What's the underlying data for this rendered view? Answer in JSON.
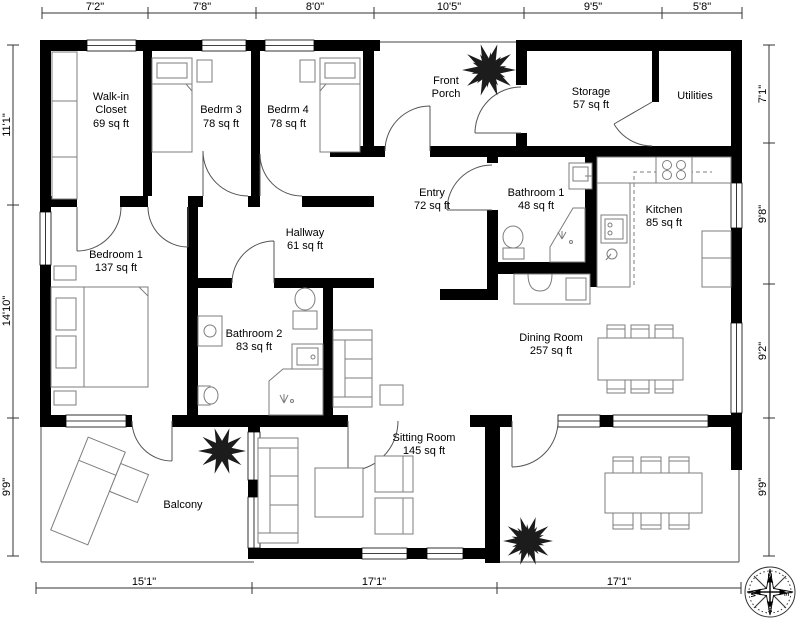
{
  "colors": {
    "wall": "#000000",
    "furniture": "#7d7d7d",
    "door": "#555555",
    "outline": "#6a6a6a",
    "plant": "#1c1c1c"
  },
  "rooms": {
    "walkin": {
      "l1": "Walk-in",
      "l2": "Closet",
      "area": "69 sq ft"
    },
    "bedrm3": {
      "name": "Bedrm 3",
      "area": "78 sq ft"
    },
    "bedrm4": {
      "name": "Bedrm 4",
      "area": "78 sq ft"
    },
    "porch": {
      "l1": "Front",
      "l2": "Porch"
    },
    "storage": {
      "name": "Storage",
      "area": "57 sq ft"
    },
    "utilities": {
      "name": "Utilities"
    },
    "entry": {
      "name": "Entry",
      "area": "72 sq ft"
    },
    "bath1": {
      "name": "Bathroom 1",
      "area": "48 sq ft"
    },
    "kitchen": {
      "name": "Kitchen",
      "area": "85 sq ft"
    },
    "bedroom1": {
      "name": "Bedroom 1",
      "area": "137 sq ft"
    },
    "hallway": {
      "name": "Hallway",
      "area": "61 sq ft"
    },
    "bath2": {
      "name": "Bathroom 2",
      "area": "83 sq ft"
    },
    "dining": {
      "name": "Dining Room",
      "area": "257 sq ft"
    },
    "sitting": {
      "name": "Sitting Room",
      "area": "145 sq ft"
    },
    "balcony": {
      "name": "Balcony"
    }
  },
  "dims": {
    "top": [
      "7'2\"",
      "7'8\"",
      "8'0\"",
      "10'5\"",
      "9'5\"",
      "5'8\""
    ],
    "left": [
      "11'1\"",
      "14'10\"",
      "9'9\""
    ],
    "right": [
      "7'1\"",
      "9'8\"",
      "9'2\"",
      "9'9\""
    ],
    "bottom": [
      "15'1\"",
      "17'1\"",
      "17'1\""
    ]
  },
  "compass": {
    "n": "N",
    "e": "E",
    "s": "S",
    "w": "W"
  }
}
